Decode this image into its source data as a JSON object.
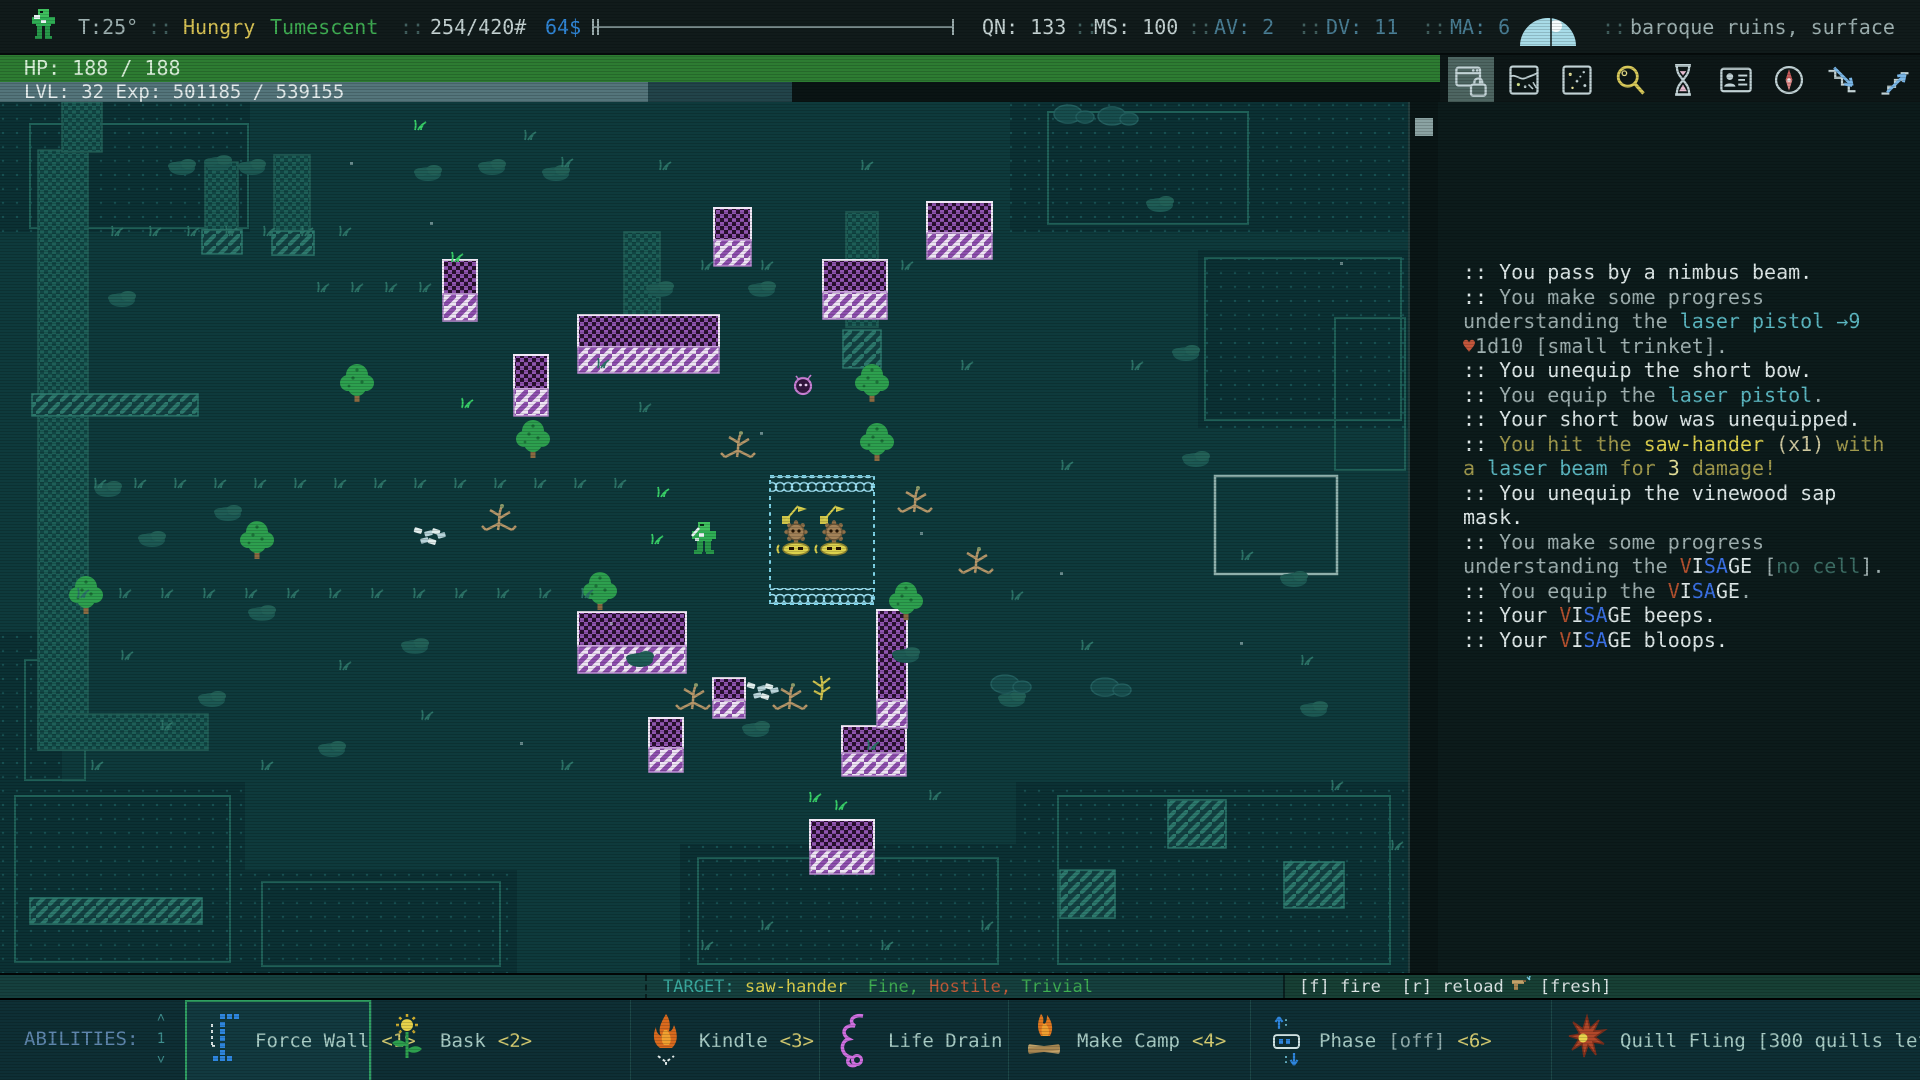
{
  "palette": {
    "wh": "#dfe9e9",
    "gr": "#9fb0b0",
    "te": "#5cb8c2",
    "he": "#c4573c",
    "yw": "#ded24e",
    "yw2": "#e6e29a",
    "ol": "#a19a4d",
    "ol2": "#cfc9a0",
    "vr": "#b5512f",
    "vb": "#3b72e8",
    "dm": "#3d6f66",
    "yellow": "#d9c455",
    "green": "#3fae53",
    "blue": "#3087d8",
    "light": "#c6d4d4",
    "gray": "#9fb2b2",
    "steel": "#4a7f96",
    "teal2": "#3aaa9f",
    "red": "#c05b3a",
    "mapBg": "#0e3a3c"
  },
  "top_bar": {
    "items": [
      {
        "type": "sprite",
        "x": 28,
        "name": "player-sprite-icon"
      },
      {
        "type": "text",
        "x": 78,
        "text": "T:25°",
        "c": "gray",
        "name": "temperature"
      },
      {
        "type": "sep",
        "x": 148
      },
      {
        "type": "text",
        "x": 183,
        "text": "Hungry",
        "c": "yellow",
        "name": "status-hungry"
      },
      {
        "type": "text",
        "x": 270,
        "text": "Tumescent",
        "c": "green",
        "name": "status-tumescent"
      },
      {
        "type": "sep",
        "x": 400
      },
      {
        "type": "text",
        "x": 430,
        "text": "254/420#",
        "c": "light",
        "name": "carry-weight"
      },
      {
        "type": "text",
        "x": 545,
        "text": "64$",
        "c": "blue",
        "name": "money"
      },
      {
        "type": "slider",
        "x": 592,
        "w": 362,
        "name": "top-progress-bar"
      },
      {
        "type": "text",
        "x": 982,
        "text": "QN: 133",
        "c": "light",
        "name": "quickness"
      },
      {
        "type": "sep",
        "x": 1074
      },
      {
        "type": "text",
        "x": 1094,
        "text": "MS: 100",
        "c": "light",
        "name": "move-speed"
      },
      {
        "type": "sep",
        "x": 1188
      },
      {
        "type": "text",
        "x": 1214,
        "text": "AV: 2",
        "c": "steel",
        "name": "armor-value"
      },
      {
        "type": "sep",
        "x": 1298
      },
      {
        "type": "text",
        "x": 1326,
        "text": "DV: 11",
        "c": "steel",
        "name": "dodge-value"
      },
      {
        "type": "sep",
        "x": 1422
      },
      {
        "type": "text",
        "x": 1450,
        "text": "MA: 6",
        "c": "steel",
        "name": "mental-armor"
      },
      {
        "type": "weather",
        "x": 1516,
        "name": "weather-moon-icon"
      },
      {
        "type": "sep",
        "x": 1602
      },
      {
        "type": "text",
        "x": 1630,
        "text": "baroque ruins, surface",
        "c": "gray",
        "name": "location"
      }
    ]
  },
  "hp_bar": {
    "text": "HP: 188 / 188"
  },
  "lvl_bar": {
    "text": "LVL: 32 Exp: 501185 / 539155",
    "fill_px": 648
  },
  "toolbar": {
    "buttons": [
      {
        "name": "ui-lock",
        "active": true
      },
      {
        "name": "world-map",
        "active": false
      },
      {
        "name": "starfield",
        "active": false
      },
      {
        "name": "inspect",
        "active": false
      },
      {
        "name": "wait",
        "active": false
      },
      {
        "name": "character-sheet",
        "active": false
      },
      {
        "name": "compass",
        "active": false
      },
      {
        "name": "stairs-down",
        "active": false
      },
      {
        "name": "stairs-up",
        "active": false
      }
    ]
  },
  "log": {
    "lines": [
      [
        [
          ":: You pass by a nimbus beam.",
          "wh"
        ]
      ],
      [
        [
          ":: ",
          "wh"
        ],
        [
          "You make some progress",
          "gr"
        ]
      ],
      [
        [
          "understanding the ",
          "gr"
        ],
        [
          "laser pistol",
          "te"
        ],
        [
          " ",
          "gr"
        ],
        [
          "→9",
          "te"
        ]
      ],
      [
        [
          "♥",
          "he"
        ],
        [
          "1d10 [small trinket].",
          "gr"
        ]
      ],
      [
        [
          ":: You unequip the short bow.",
          "wh"
        ]
      ],
      [
        [
          ":: ",
          "wh"
        ],
        [
          "You equip the ",
          "gr"
        ],
        [
          "laser pistol",
          "te"
        ],
        [
          ".",
          "gr"
        ]
      ],
      [
        [
          ":: Your short bow was unequipped.",
          "wh"
        ]
      ],
      [
        [
          ":: ",
          "wh"
        ],
        [
          "You hit the ",
          "ol"
        ],
        [
          "saw-hander",
          "yw"
        ],
        [
          " (x1) ",
          "ol2"
        ],
        [
          "with",
          "ol"
        ]
      ],
      [
        [
          "a ",
          "ol"
        ],
        [
          "laser beam",
          "te"
        ],
        [
          " for ",
          "ol"
        ],
        [
          "3",
          "yw2"
        ],
        [
          " damage!",
          "ol"
        ]
      ],
      [
        [
          ":: You unequip the vinewood sap",
          "wh"
        ]
      ],
      [
        [
          "mask.",
          "wh"
        ]
      ],
      [
        [
          ":: ",
          "wh"
        ],
        [
          "You make some progress",
          "gr"
        ]
      ],
      [
        [
          "understanding the ",
          "gr"
        ],
        [
          "V",
          "vr"
        ],
        [
          "I",
          "wh"
        ],
        [
          "S",
          "vb"
        ],
        [
          "A",
          "vb"
        ],
        [
          "GE",
          "wh"
        ],
        [
          " [",
          "gr"
        ],
        [
          "no cell",
          "dm"
        ],
        [
          "].",
          "gr"
        ]
      ],
      [
        [
          ":: ",
          "wh"
        ],
        [
          "You equip the ",
          "gr"
        ],
        [
          "V",
          "vr"
        ],
        [
          "I",
          "wh"
        ],
        [
          "S",
          "vb"
        ],
        [
          "A",
          "vb"
        ],
        [
          "GE",
          "wh"
        ],
        [
          ".",
          "gr"
        ]
      ],
      [
        [
          ":: Your ",
          "wh"
        ],
        [
          "V",
          "vr"
        ],
        [
          "I",
          "wh"
        ],
        [
          "S",
          "vb"
        ],
        [
          "A",
          "vb"
        ],
        [
          "GE",
          "wh"
        ],
        [
          " beeps.",
          "wh"
        ]
      ],
      [
        [
          ":: Your ",
          "wh"
        ],
        [
          "V",
          "vr"
        ],
        [
          "I",
          "wh"
        ],
        [
          "S",
          "vb"
        ],
        [
          "A",
          "vb"
        ],
        [
          "GE",
          "wh"
        ],
        [
          " bloops.",
          "wh"
        ]
      ]
    ]
  },
  "status_bar": {
    "active_effects_label": "ACTIVE EFFECTS:",
    "target_segments": [
      [
        "TARGET: ",
        "teal2"
      ],
      [
        "saw-hander",
        "yw"
      ],
      [
        "  ",
        "wh"
      ],
      [
        "Fine,",
        "green"
      ],
      [
        " ",
        "wh"
      ],
      [
        "Hostile,",
        "red"
      ],
      [
        " ",
        "wh"
      ],
      [
        "Trivial",
        "green"
      ]
    ],
    "fire_hint": "[f] fire  [r] reload",
    "fresh_label": "[fresh]"
  },
  "abilities": {
    "label": "ABILITIES:",
    "page": "1",
    "items": [
      {
        "icon": "force-wall",
        "label": "Force Wall",
        "mod": "",
        "key": "<1>",
        "w": 186,
        "selected": true
      },
      {
        "icon": "bask",
        "label": "Bask",
        "mod": "",
        "key": "<2>",
        "w": 259,
        "selected": false
      },
      {
        "icon": "kindle",
        "label": "Kindle",
        "mod": "",
        "key": "<3>",
        "w": 189,
        "selected": false
      },
      {
        "icon": "life-drain",
        "label": "Life Drain",
        "mod": "",
        "key": "",
        "w": 189,
        "selected": false
      },
      {
        "icon": "make-camp",
        "label": "Make Camp",
        "mod": "",
        "key": "<4>",
        "w": 242,
        "selected": false
      },
      {
        "icon": "phase",
        "label": "Phase",
        "mod": "[off]",
        "key": "<6>",
        "w": 301,
        "selected": false
      },
      {
        "icon": "quill-fling",
        "label": "Quill Fling [300 quills left]",
        "mod": "",
        "key": "<7>",
        "w": 369,
        "selected": false
      }
    ]
  },
  "map": {
    "dark_zones": [
      [
        0,
        0,
        250,
        130
      ],
      [
        1010,
        0,
        398,
        130
      ],
      [
        1198,
        148,
        210,
        178
      ],
      [
        0,
        530,
        62,
        152
      ],
      [
        0,
        680,
        245,
        191
      ],
      [
        245,
        768,
        272,
        103
      ],
      [
        680,
        742,
        336,
        129
      ],
      [
        1016,
        680,
        392,
        191
      ]
    ],
    "outlines": [
      [
        30,
        22,
        218,
        104
      ],
      [
        1048,
        10,
        200,
        112
      ],
      [
        1205,
        156,
        196,
        162
      ],
      [
        1335,
        216,
        70,
        152
      ],
      [
        25,
        558,
        60,
        120
      ],
      [
        15,
        694,
        215,
        166
      ],
      [
        262,
        780,
        238,
        84
      ],
      [
        698,
        756,
        300,
        106
      ],
      [
        1058,
        694,
        332,
        168
      ]
    ],
    "bright_outlines": [
      [
        1215,
        374,
        122,
        98
      ]
    ],
    "teal_walls": [
      [
        38,
        48,
        50,
        600
      ],
      [
        38,
        612,
        170,
        36
      ],
      [
        62,
        0,
        40,
        50
      ],
      [
        205,
        60,
        33,
        68
      ],
      [
        274,
        53,
        36,
        76
      ],
      [
        624,
        130,
        36,
        90
      ],
      [
        846,
        110,
        32,
        115
      ]
    ],
    "teal_faces": [
      [
        202,
        128,
        40,
        24
      ],
      [
        272,
        129,
        42,
        24
      ],
      [
        622,
        224,
        40,
        42
      ],
      [
        843,
        228,
        38,
        38
      ],
      [
        32,
        292,
        166,
        22
      ],
      [
        30,
        796,
        172,
        26
      ],
      [
        1168,
        698,
        58,
        48
      ],
      [
        1284,
        760,
        60,
        46
      ],
      [
        1060,
        768,
        55,
        48
      ]
    ],
    "purple_walls": [
      [
        443,
        158,
        34,
        61
      ],
      [
        714,
        106,
        37,
        58
      ],
      [
        927,
        100,
        65,
        57
      ],
      [
        823,
        158,
        64,
        59
      ],
      [
        578,
        213,
        141,
        58
      ],
      [
        514,
        253,
        34,
        61
      ],
      [
        578,
        510,
        108,
        61
      ],
      [
        713,
        576,
        32,
        40
      ],
      [
        649,
        616,
        34,
        54
      ],
      [
        842,
        624,
        64,
        50
      ],
      [
        877,
        508,
        30,
        118
      ],
      [
        810,
        718,
        64,
        54
      ]
    ],
    "pen": {
      "x": 770,
      "y": 374,
      "w": 104,
      "h": 128
    },
    "machines": [
      [
        782,
        400
      ],
      [
        820,
        400
      ]
    ],
    "player": [
      688,
      420
    ],
    "critter": [
      800,
      280
    ],
    "plant": [
      821,
      574
    ],
    "trees": [
      [
        357,
        278
      ],
      [
        533,
        334
      ],
      [
        257,
        435
      ],
      [
        872,
        278
      ],
      [
        877,
        337
      ],
      [
        86,
        490
      ],
      [
        600,
        486
      ],
      [
        906,
        496
      ]
    ],
    "tan_trees": [
      [
        496,
        404
      ],
      [
        912,
        386
      ],
      [
        973,
        447
      ],
      [
        690,
        583
      ],
      [
        787,
        583
      ],
      [
        735,
        331
      ]
    ],
    "shrubs": [
      [
        182,
        66
      ],
      [
        218,
        62
      ],
      [
        252,
        66
      ],
      [
        428,
        72
      ],
      [
        492,
        66
      ],
      [
        556,
        72
      ],
      [
        122,
        198
      ],
      [
        660,
        188
      ],
      [
        762,
        188
      ],
      [
        1160,
        103
      ],
      [
        1186,
        252
      ],
      [
        1196,
        358
      ],
      [
        640,
        558
      ],
      [
        152,
        438
      ],
      [
        228,
        412
      ],
      [
        262,
        512
      ],
      [
        212,
        598
      ],
      [
        108,
        388
      ],
      [
        332,
        648
      ],
      [
        756,
        628
      ],
      [
        906,
        554
      ],
      [
        1012,
        598
      ],
      [
        1294,
        478
      ],
      [
        1314,
        608
      ],
      [
        415,
        545
      ]
    ],
    "rubble": [
      [
        1068,
        12
      ],
      [
        1112,
        14
      ],
      [
        1005,
        582
      ],
      [
        1105,
        585
      ]
    ],
    "crystals": [
      [
        415,
        425
      ],
      [
        748,
        580
      ]
    ],
    "grass": [
      [
        112,
        124,
        0
      ],
      [
        150,
        124,
        0
      ],
      [
        188,
        124,
        0
      ],
      [
        226,
        124,
        0
      ],
      [
        264,
        124,
        0
      ],
      [
        302,
        124,
        0
      ],
      [
        340,
        124,
        0
      ],
      [
        318,
        180,
        0
      ],
      [
        352,
        180,
        0
      ],
      [
        386,
        180,
        0
      ],
      [
        420,
        180,
        0
      ],
      [
        95,
        376,
        0
      ],
      [
        135,
        376,
        0
      ],
      [
        175,
        376,
        0
      ],
      [
        215,
        376,
        0
      ],
      [
        255,
        376,
        0
      ],
      [
        295,
        376,
        0
      ],
      [
        335,
        376,
        0
      ],
      [
        375,
        376,
        0
      ],
      [
        415,
        376,
        0
      ],
      [
        455,
        376,
        0
      ],
      [
        495,
        376,
        0
      ],
      [
        535,
        376,
        0
      ],
      [
        575,
        376,
        0
      ],
      [
        615,
        376,
        0
      ],
      [
        78,
        486,
        0
      ],
      [
        120,
        486,
        0
      ],
      [
        162,
        486,
        0
      ],
      [
        204,
        486,
        0
      ],
      [
        246,
        486,
        0
      ],
      [
        288,
        486,
        0
      ],
      [
        330,
        486,
        0
      ],
      [
        372,
        486,
        0
      ],
      [
        414,
        486,
        0
      ],
      [
        456,
        486,
        0
      ],
      [
        498,
        486,
        0
      ],
      [
        540,
        486,
        0
      ],
      [
        582,
        486,
        0
      ],
      [
        415,
        18,
        1
      ],
      [
        452,
        150,
        1
      ],
      [
        462,
        296,
        1
      ],
      [
        658,
        385,
        1
      ],
      [
        652,
        432,
        1
      ],
      [
        810,
        690,
        1
      ],
      [
        836,
        698,
        1
      ],
      [
        525,
        28,
        0
      ],
      [
        562,
        55,
        0
      ],
      [
        660,
        58,
        0
      ],
      [
        702,
        158,
        0
      ],
      [
        762,
        158,
        0
      ],
      [
        862,
        58,
        0
      ],
      [
        902,
        158,
        0
      ],
      [
        962,
        258,
        0
      ],
      [
        1062,
        358,
        0
      ],
      [
        1132,
        258,
        0
      ],
      [
        1242,
        448,
        0
      ],
      [
        1302,
        553,
        0
      ],
      [
        868,
        638,
        0
      ],
      [
        930,
        688,
        0
      ],
      [
        340,
        558,
        0
      ],
      [
        422,
        608,
        0
      ],
      [
        562,
        658,
        0
      ],
      [
        262,
        658,
        0
      ],
      [
        162,
        618,
        0
      ],
      [
        92,
        658,
        0
      ],
      [
        122,
        548,
        0
      ],
      [
        1012,
        488,
        0
      ],
      [
        1082,
        538,
        0
      ],
      [
        1332,
        678,
        0
      ],
      [
        1392,
        738,
        0
      ],
      [
        702,
        838,
        0
      ],
      [
        762,
        818,
        0
      ],
      [
        882,
        838,
        0
      ],
      [
        982,
        818,
        0
      ],
      [
        598,
        256,
        0
      ],
      [
        640,
        300,
        0
      ]
    ],
    "specks": [
      [
        430,
        120
      ],
      [
        650,
        240
      ],
      [
        920,
        430
      ],
      [
        520,
        640
      ],
      [
        1240,
        540
      ],
      [
        350,
        60
      ],
      [
        760,
        330
      ],
      [
        610,
        520
      ],
      [
        1340,
        160
      ],
      [
        1060,
        470
      ]
    ]
  }
}
